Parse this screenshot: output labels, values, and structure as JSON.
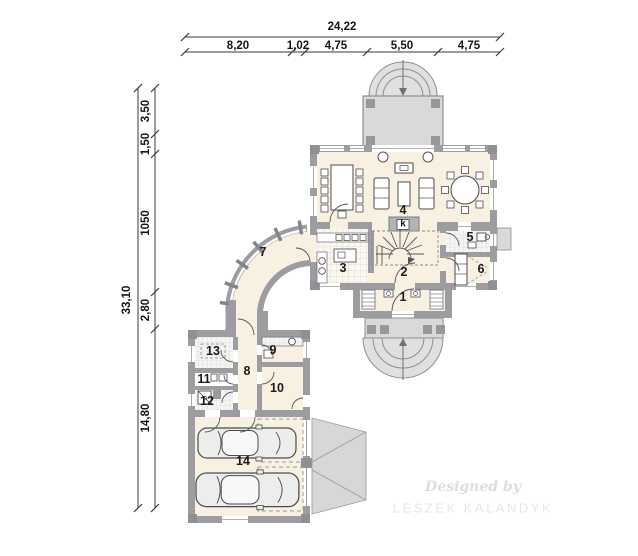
{
  "dims_top": {
    "total": "24,22",
    "seg": [
      "8,20",
      "1,02",
      "4,75",
      "5,50",
      "4,75"
    ]
  },
  "dims_left": {
    "total": "33,10",
    "seg": [
      "3,50",
      "1,50",
      "1050",
      "2,80",
      "14,80"
    ]
  },
  "rooms": {
    "r1": "1",
    "r2": "2",
    "r3": "3",
    "r4": "4",
    "r5": "5",
    "r6": "6",
    "r7": "7",
    "r8": "8",
    "r9": "9",
    "r10": "10",
    "r11": "11",
    "r12": "12",
    "r13": "13",
    "r14": "14"
  },
  "fireplace": {
    "label": "k"
  },
  "watermark": {
    "line1": "Designed by",
    "line2": "LESZEK KALANDYK"
  },
  "colors": {
    "wall": "#9c9ca1",
    "floor": "#f8f1e2",
    "terrace": "#d9d9d9",
    "dim_text": "#141414"
  }
}
